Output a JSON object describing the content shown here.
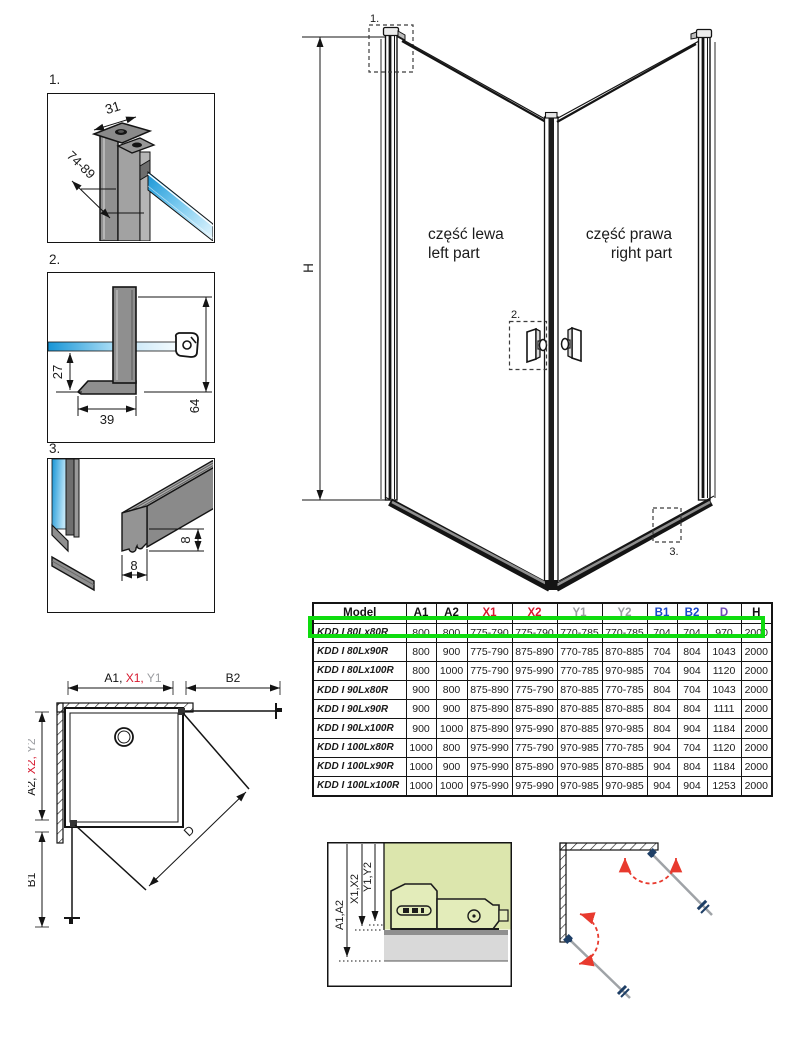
{
  "details": {
    "d1": {
      "label": "1.",
      "dim_width": "31",
      "dim_range": "74-89"
    },
    "d2": {
      "label": "2.",
      "dim_depth": "27",
      "dim_width": "39",
      "dim_height": "64"
    },
    "d3": {
      "label": "3.",
      "dim_h": "8",
      "dim_w": "8"
    }
  },
  "main": {
    "h_label": "H",
    "callout1": "1.",
    "callout2": "2.",
    "callout3": "3.",
    "left_pl": "część lewa",
    "left_en": "left part",
    "right_pl": "część prawa",
    "right_en": "right part"
  },
  "plan": {
    "a1": "A1,",
    "x1": " X1,",
    "y1": " Y1",
    "b2": "B2",
    "a2": "A2, ",
    "x2": "X2, ",
    "y2": "Y2",
    "b1": "B1",
    "d": "D"
  },
  "section": {
    "a": "A1,A2",
    "x": "X1,X2",
    "y": "Y1,Y2"
  },
  "table": {
    "headers": [
      {
        "label": "Model",
        "color": "#111111"
      },
      {
        "label": "A1",
        "color": "#111111"
      },
      {
        "label": "A2",
        "color": "#111111"
      },
      {
        "label": "X1",
        "color": "#d6182e"
      },
      {
        "label": "X2",
        "color": "#d6182e"
      },
      {
        "label": "Y1",
        "color": "#9b9da1"
      },
      {
        "label": "Y2",
        "color": "#9b9da1"
      },
      {
        "label": "B1",
        "color": "#1847c8"
      },
      {
        "label": "B2",
        "color": "#1847c8"
      },
      {
        "label": "D",
        "color": "#6f4db5"
      },
      {
        "label": "H",
        "color": "#111111"
      }
    ],
    "rows": [
      {
        "model": "KDD I 80Lx80R",
        "values": [
          "800",
          "800",
          "775-790",
          "775-790",
          "770-785",
          "770-785",
          "704",
          "704",
          "970",
          "2000"
        ],
        "highlighted": true
      },
      {
        "model": "KDD I 80Lx90R",
        "values": [
          "800",
          "900",
          "775-790",
          "875-890",
          "770-785",
          "870-885",
          "704",
          "804",
          "1043",
          "2000"
        ],
        "highlighted": false
      },
      {
        "model": "KDD I 80Lx100R",
        "values": [
          "800",
          "1000",
          "775-790",
          "975-990",
          "770-785",
          "970-985",
          "704",
          "904",
          "1120",
          "2000"
        ],
        "highlighted": false
      },
      {
        "model": "KDD I 90Lx80R",
        "values": [
          "900",
          "800",
          "875-890",
          "775-790",
          "870-885",
          "770-785",
          "804",
          "704",
          "1043",
          "2000"
        ],
        "highlighted": false
      },
      {
        "model": "KDD I 90Lx90R",
        "values": [
          "900",
          "900",
          "875-890",
          "875-890",
          "870-885",
          "870-885",
          "804",
          "804",
          "1111",
          "2000"
        ],
        "highlighted": false
      },
      {
        "model": "KDD I 90Lx100R",
        "values": [
          "900",
          "1000",
          "875-890",
          "975-990",
          "870-885",
          "970-985",
          "804",
          "904",
          "1184",
          "2000"
        ],
        "highlighted": false
      },
      {
        "model": "KDD I 100Lx80R",
        "values": [
          "1000",
          "800",
          "975-990",
          "775-790",
          "970-985",
          "770-785",
          "904",
          "704",
          "1120",
          "2000"
        ],
        "highlighted": false
      },
      {
        "model": "KDD I 100Lx90R",
        "values": [
          "1000",
          "900",
          "975-990",
          "875-890",
          "970-985",
          "870-885",
          "904",
          "804",
          "1184",
          "2000"
        ],
        "highlighted": false
      },
      {
        "model": "KDD I 100Lx100R",
        "values": [
          "1000",
          "1000",
          "975-990",
          "975-990",
          "970-985",
          "970-985",
          "904",
          "904",
          "1253",
          "2000"
        ],
        "highlighted": false
      }
    ],
    "highlight_color": "#0edc0e"
  },
  "colors": {
    "red": "#d6182e",
    "gray": "#9b9da1",
    "blue": "#1847c8",
    "purple": "#6f4db5",
    "glass_dark": "#1795d6",
    "glass_light": "#e8f7fe",
    "wall_green": "#dce6ad",
    "arc_red": "#e83a2e",
    "fitting_blue": "#1e3f66"
  }
}
